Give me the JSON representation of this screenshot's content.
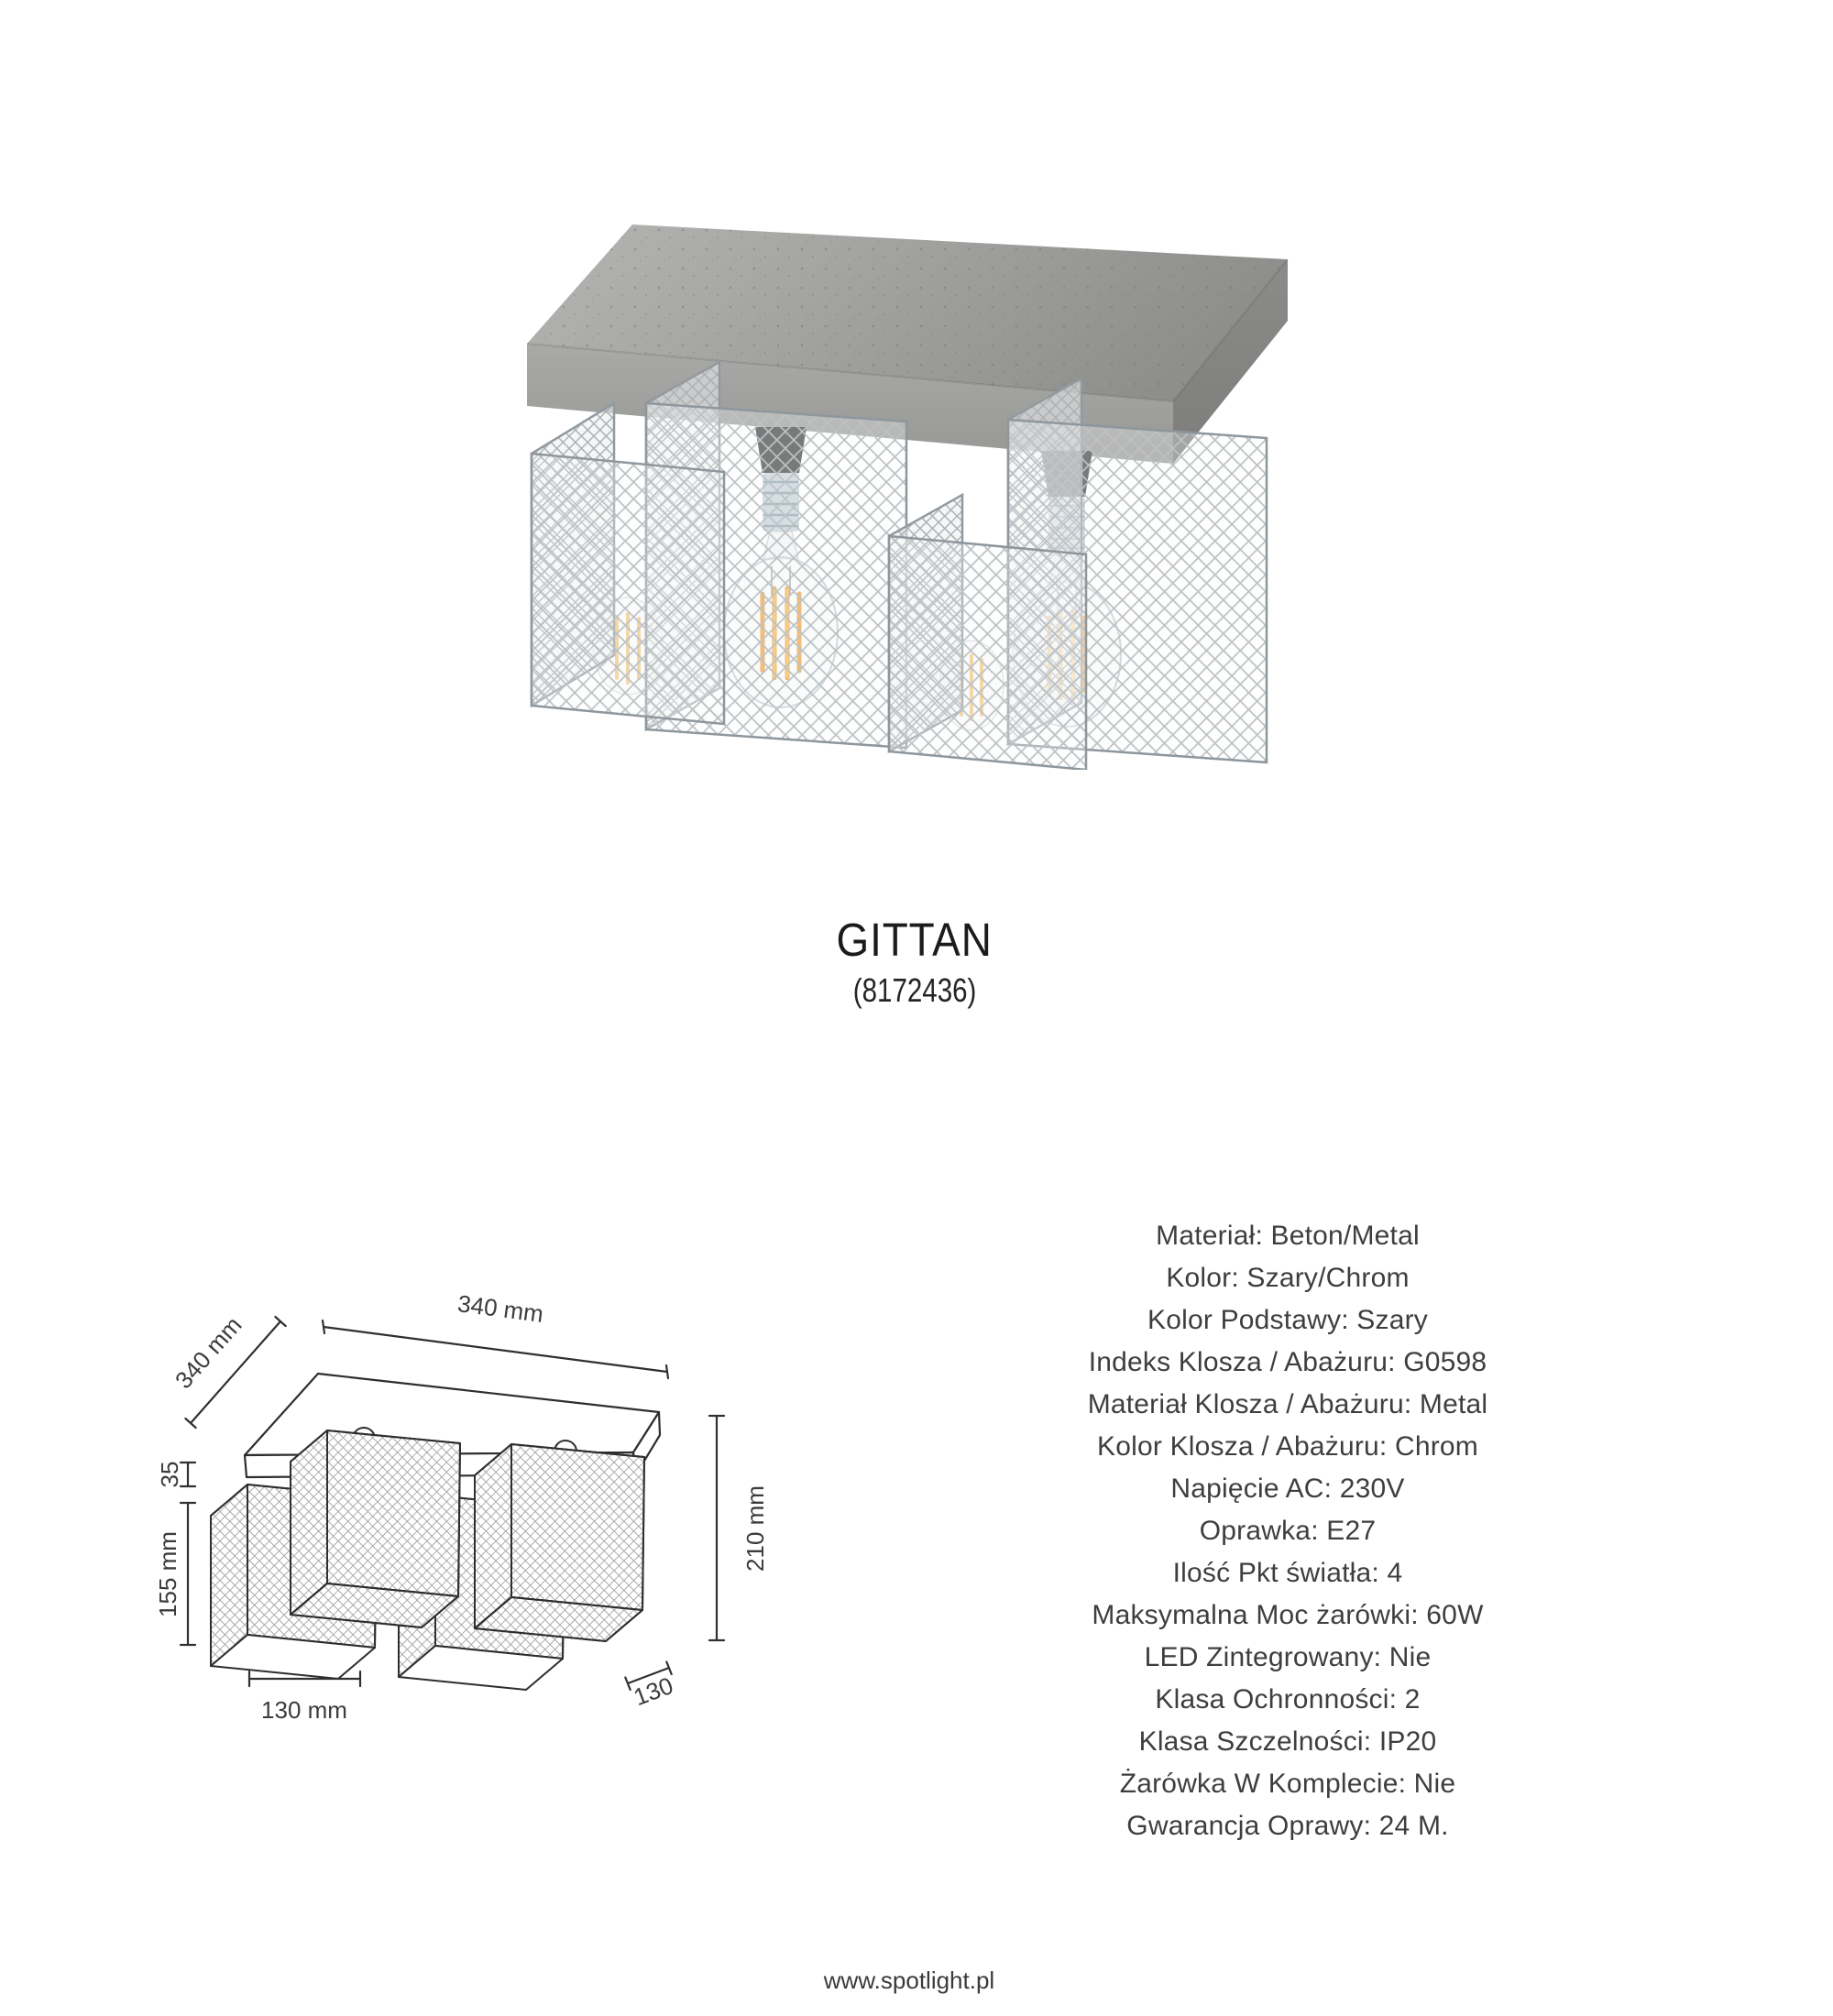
{
  "product": {
    "name": "GITTAN",
    "code": "(8172436)"
  },
  "drawing_dims": {
    "top_width": "340 mm",
    "depth": "340 mm",
    "base_thickness": "35",
    "shade_height": "155 mm",
    "total_height": "210 mm",
    "shade_width": "130 mm",
    "shade_depth": "130"
  },
  "specs": {
    "lines": [
      "Materiał: Beton/Metal",
      "Kolor: Szary/Chrom",
      "Kolor Podstawy: Szary",
      "Indeks Klosza / Abażuru: G0598",
      "Materiał Klosza / Abażuru: Metal",
      "Kolor Klosza / Abażuru: Chrom",
      "Napięcie AC: 230V",
      "Oprawka: E27",
      "Ilość Pkt światła: 4",
      "Maksymalna Moc żarówki: 60W",
      "LED Zintegrowany: Nie",
      "Klasa Ochronności: 2",
      "Klasa Szczelności: IP20",
      "Żarówka W Komplecie: Nie",
      "Gwarancja Oprawy: 24 M."
    ]
  },
  "footer": {
    "website": "www.spotlight.pl"
  }
}
